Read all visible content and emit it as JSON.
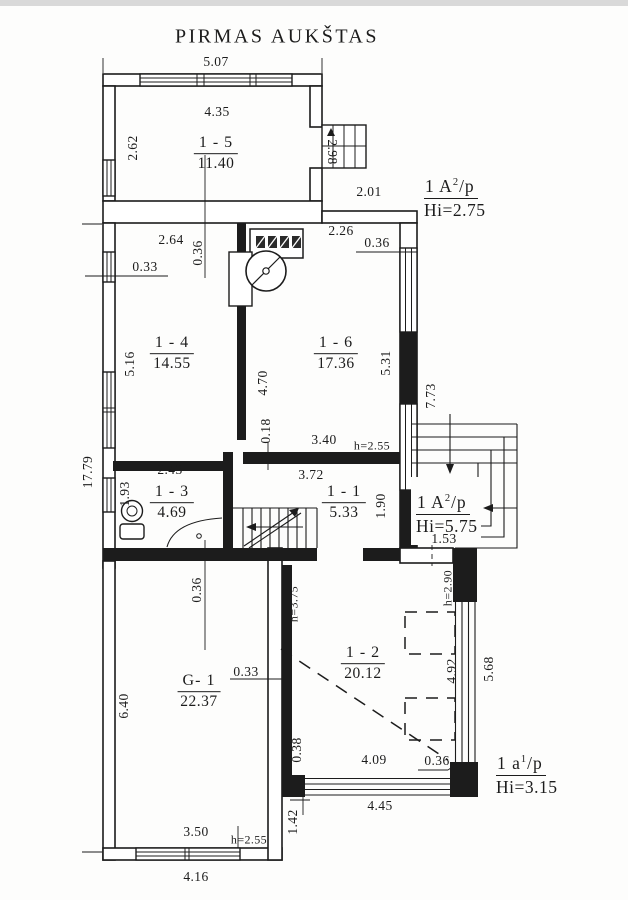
{
  "page": {
    "title": "PIRMAS AUKŠTAS"
  },
  "rooms": {
    "r15": {
      "name": "1 - 5",
      "area": "11.40"
    },
    "r14": {
      "name": "1 - 4",
      "area": "14.55"
    },
    "r16": {
      "name": "1 - 6",
      "area": "17.36"
    },
    "r13": {
      "name": "1 - 3",
      "area": "4.69"
    },
    "r11": {
      "name": "1 - 1",
      "area": "5.33"
    },
    "r12": {
      "name": "1 - 2",
      "area": "20.12"
    },
    "g1": {
      "name": "G- 1",
      "area": "22.37"
    }
  },
  "annotations": {
    "a1": {
      "prefix": "1 A",
      "sup": "2",
      "suffix": "/p",
      "height": "Hi=2.75"
    },
    "a2": {
      "prefix": "1 A",
      "sup": "2",
      "suffix": "/p",
      "height": "Hi=5.75"
    },
    "a3": {
      "prefix": "1 a",
      "sup": "1",
      "suffix": "/p",
      "height": "Hi=3.15"
    }
  },
  "dims": {
    "d507": "5.07",
    "d435": "4.35",
    "d262": "2.62",
    "d298": "2.98",
    "d201": "2.01",
    "d264": "2.64",
    "d036a": "0.36",
    "d033a": "0.33",
    "d226": "2.26",
    "d036b": "0.36",
    "d516": "5.16",
    "d470": "4.70",
    "d531": "5.31",
    "d773": "7.73",
    "d018": "0.18",
    "d340": "3.40",
    "h255a": "h=2.55",
    "d1779": "17.79",
    "d243": "2.43",
    "d193": "1.93",
    "d372": "3.72",
    "d190": "1.90",
    "d153": "1.53",
    "d036c": "0.36",
    "h375": "h=3.75",
    "h290": "h=2.90",
    "d033b": "0.33",
    "d640": "6.40",
    "d492": "4.92",
    "d568": "5.68",
    "d038": "0.38",
    "d409": "4.09",
    "d036d": "0.36",
    "d445": "4.45",
    "d142": "1.42",
    "d350": "3.50",
    "h255b": "h=2.55",
    "d416": "4.16"
  }
}
